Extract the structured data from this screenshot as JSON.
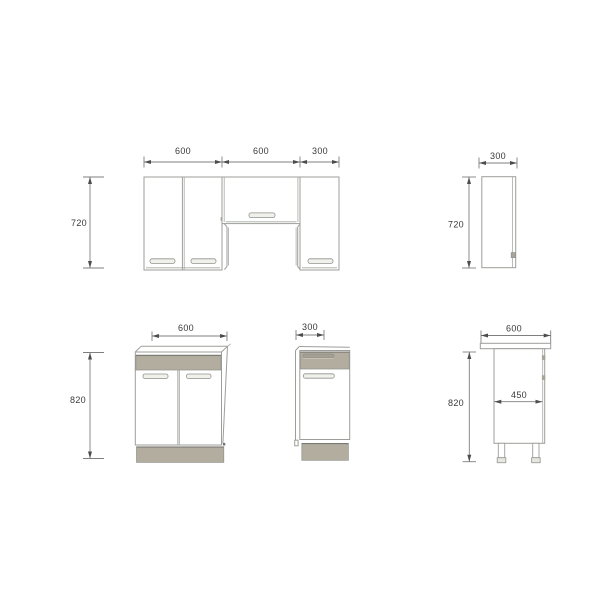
{
  "title": "Kitchen cabinet set - dimensioned technical drawing",
  "colors": {
    "line": "#9c9f99",
    "dim_line": "#7f7f7f",
    "arrow": "#4d4d4d",
    "text": "#3a3a3a",
    "cabinet_gray": "#b3ada0",
    "cabinet_gray_dark": "#a59f92",
    "edge_dark": "#74746c",
    "hinge_gray": "#a9a399",
    "foot_gray": "#e8e6e0"
  },
  "views": {
    "wall_front": {
      "name": "wall cabinets front elevation",
      "dim_width_1": "600",
      "dim_width_2": "600",
      "dim_width_3": "300",
      "dim_height": "720"
    },
    "wall_side": {
      "name": "wall cabinet side view",
      "dim_width": "300",
      "dim_height": "720"
    },
    "base_front_600": {
      "name": "base cabinet 600 front view",
      "dim_width": "600",
      "dim_height": "820"
    },
    "base_front_300": {
      "name": "base cabinet 300 front view",
      "dim_width": "300"
    },
    "base_side": {
      "name": "base cabinet side view",
      "dim_width": "600",
      "dim_depth": "450",
      "dim_height": "820"
    }
  }
}
